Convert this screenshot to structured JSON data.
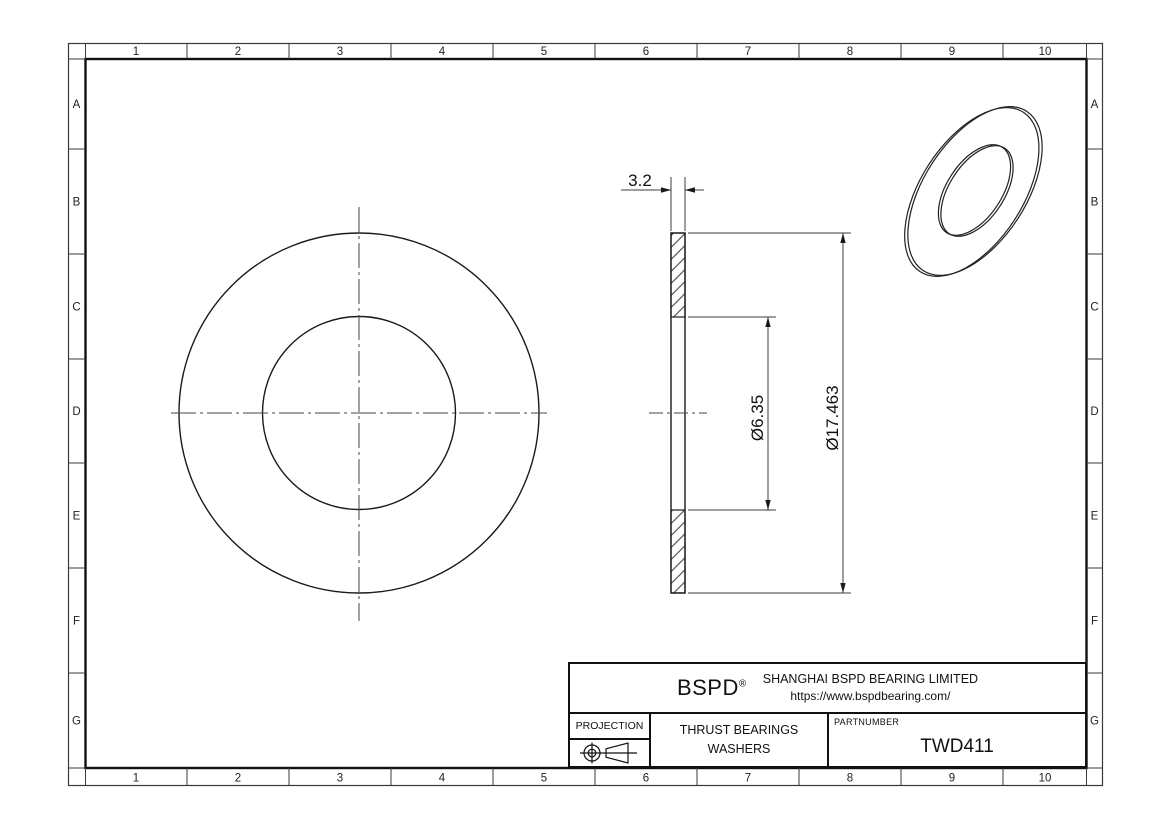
{
  "sheet": {
    "ruler_columns": [
      "1",
      "2",
      "3",
      "4",
      "5",
      "6",
      "7",
      "8",
      "9",
      "10"
    ],
    "ruler_rows": [
      "A",
      "B",
      "C",
      "D",
      "E",
      "F",
      "G"
    ]
  },
  "dimensions": {
    "thickness": "3.2",
    "bore_diameter": "Ø6.35",
    "outer_diameter": "Ø17.463"
  },
  "title_block": {
    "brand": "BSPD",
    "registered_mark": "®",
    "company": "SHANGHAI BSPD BEARING LIMITED",
    "website": "https://www.bspdbearing.com/",
    "projection_label": "PROJECTION",
    "description_line1": "THRUST BEARINGS",
    "description_line2": "WASHERS",
    "partnumber_label": "PARTNUMBER",
    "partnumber": "TWD411"
  }
}
